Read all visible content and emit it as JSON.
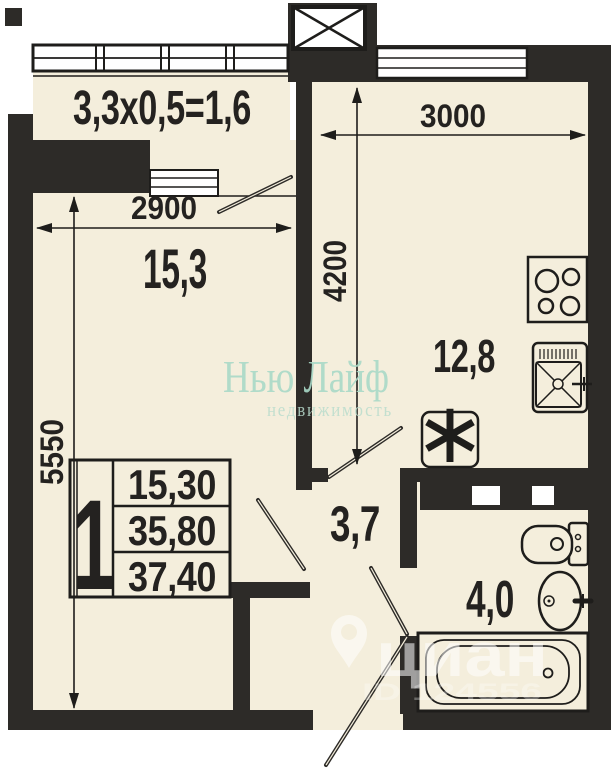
{
  "plan": {
    "balcony_formula": "3,3x0,5=1,6",
    "rooms": {
      "living": "15,3",
      "kitchen": "12,8",
      "hall": "3,7",
      "bath": "4,0"
    },
    "dims": {
      "living_width": "2900",
      "living_depth": "5550",
      "kitchen_width": "3000",
      "kitchen_depth": "4200"
    },
    "table": {
      "rooms_count": "1",
      "living_area": "15,30",
      "area_without_balcony": "35,80",
      "total_area": "37,40"
    },
    "symbols": {
      "washer": "∗"
    }
  },
  "watermarks": {
    "agency_title": "Нью Лайф",
    "agency_subtitle": "недвижимость",
    "portal_text": "циан",
    "portal_id": "ID 124556"
  },
  "colors": {
    "wall": "#2d2b28",
    "floor": "#f4eedc",
    "agency_teal": "#a9d8c6"
  }
}
